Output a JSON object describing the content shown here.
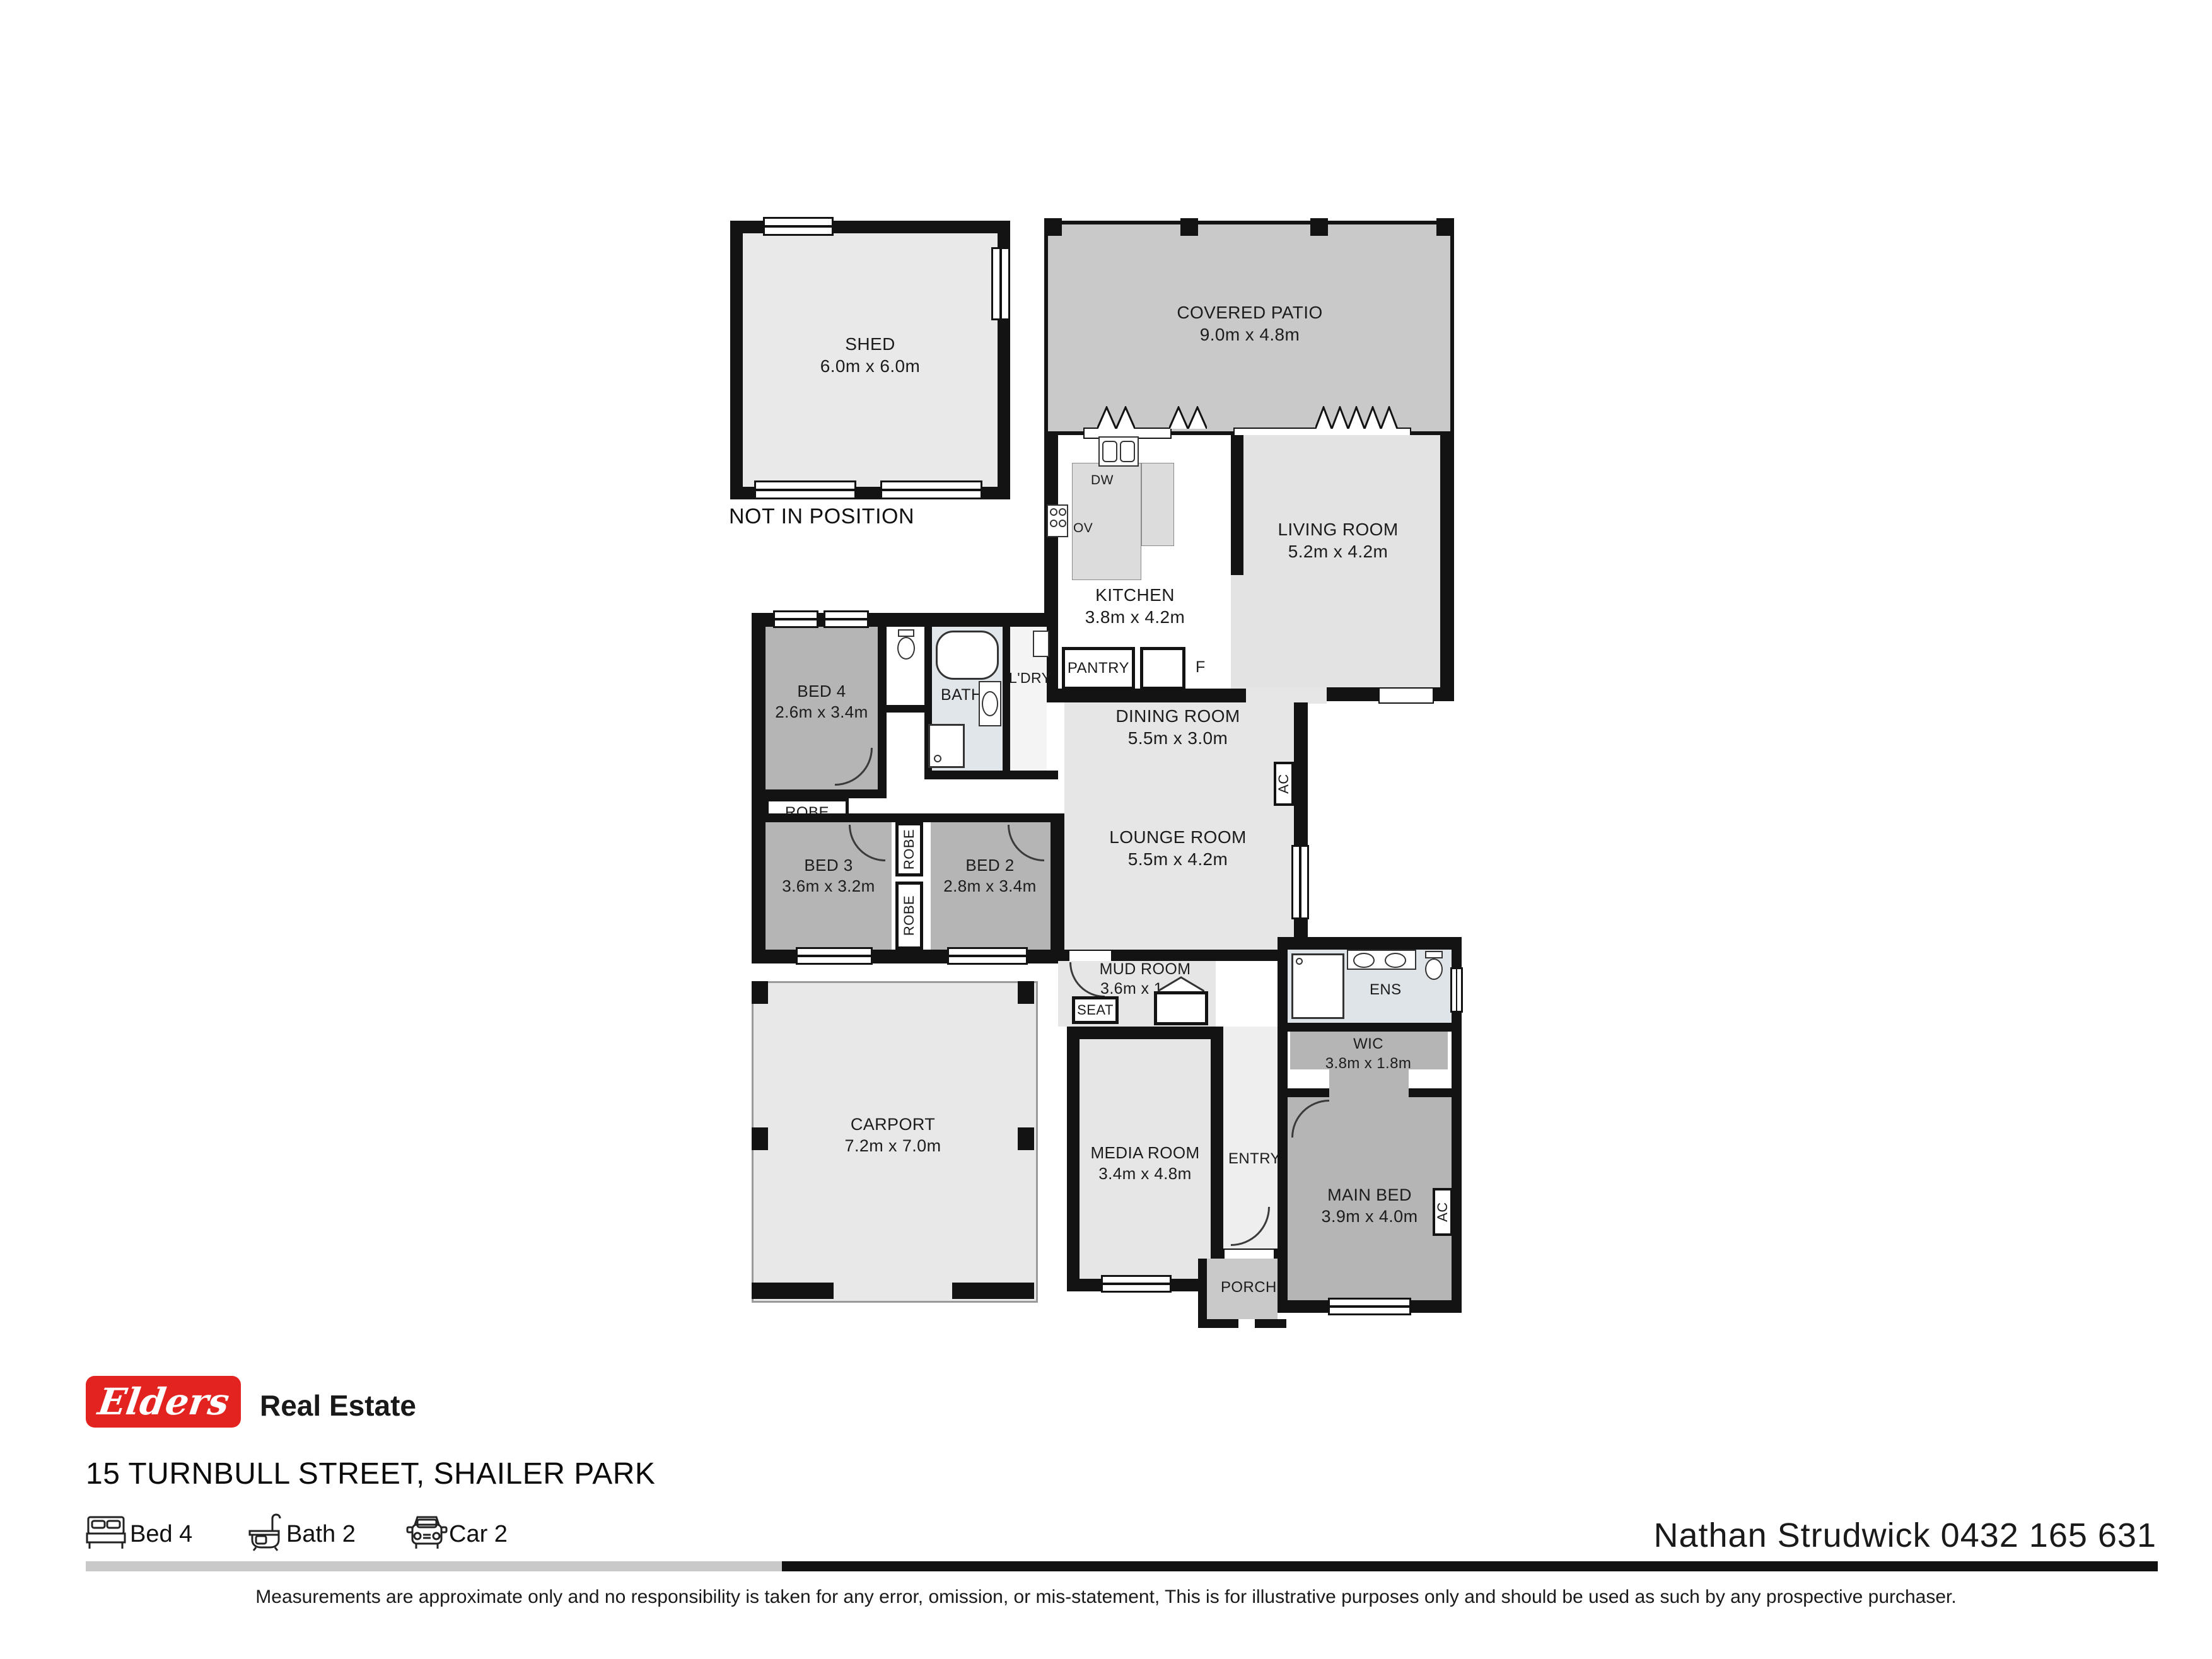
{
  "plan": {
    "annotation": "NOT IN POSITION",
    "shed": {
      "name": "SHED",
      "dims": "6.0m x 6.0m"
    },
    "covered_patio": {
      "name": "COVERED PATIO",
      "dims": "9.0m x 4.8m"
    },
    "kitchen": {
      "name": "KITCHEN",
      "dims": "3.8m x 4.2m"
    },
    "living_room": {
      "name": "LIVING ROOM",
      "dims": "5.2m x 4.2m"
    },
    "dining_room": {
      "name": "DINING ROOM",
      "dims": "5.5m x 3.0m"
    },
    "lounge_room": {
      "name": "LOUNGE ROOM",
      "dims": "5.5m x 4.2m"
    },
    "bed2": {
      "name": "BED 2",
      "dims": "2.8m x 3.4m"
    },
    "bed3": {
      "name": "BED 3",
      "dims": "3.6m x 3.2m"
    },
    "bed4": {
      "name": "BED 4",
      "dims": "2.6m x 3.4m"
    },
    "main_bed": {
      "name": "MAIN BED",
      "dims": "3.9m x 4.0m"
    },
    "wic": {
      "name": "WIC",
      "dims": "3.8m x 1.8m"
    },
    "ens": {
      "name": "ENS"
    },
    "bath": {
      "name": "BATH"
    },
    "laundry": {
      "name": "L'DRY"
    },
    "mud_room": {
      "name": "MUD ROOM",
      "dims": "3.6m x 1.6m"
    },
    "media_room": {
      "name": "MEDIA ROOM",
      "dims": "3.4m x 4.8m"
    },
    "carport": {
      "name": "CARPORT",
      "dims": "7.2m x 7.0m"
    },
    "entry": {
      "name": "ENTRY"
    },
    "porch": {
      "name": "PORCH"
    },
    "pantry": "PANTRY",
    "fridge": "F",
    "dishwasher": "DW",
    "oven": "OV",
    "robe": "ROBE",
    "seat": "SEAT",
    "ac": "AC"
  },
  "footer": {
    "logo_text": "Elders",
    "brand_suffix": "Real Estate",
    "address": "15 TURNBULL STREET, SHAILER PARK",
    "bed_feature": "Bed 4",
    "bath_feature": "Bath 2",
    "car_feature": "Car 2",
    "agent": "Nathan Strudwick 0432 165 631",
    "disclaimer": "Measurements are approximate only and no responsibility is taken for any error, omission, or mis-statement, This is for illustrative purposes only and should be used as such by any prospective purchaser."
  },
  "colors": {
    "brand_red": "#e2231f",
    "wall": "#131313",
    "room_dark": "#b5b5b5",
    "room_light": "#e6e6e6",
    "patio_gray": "#c9c9c9"
  }
}
